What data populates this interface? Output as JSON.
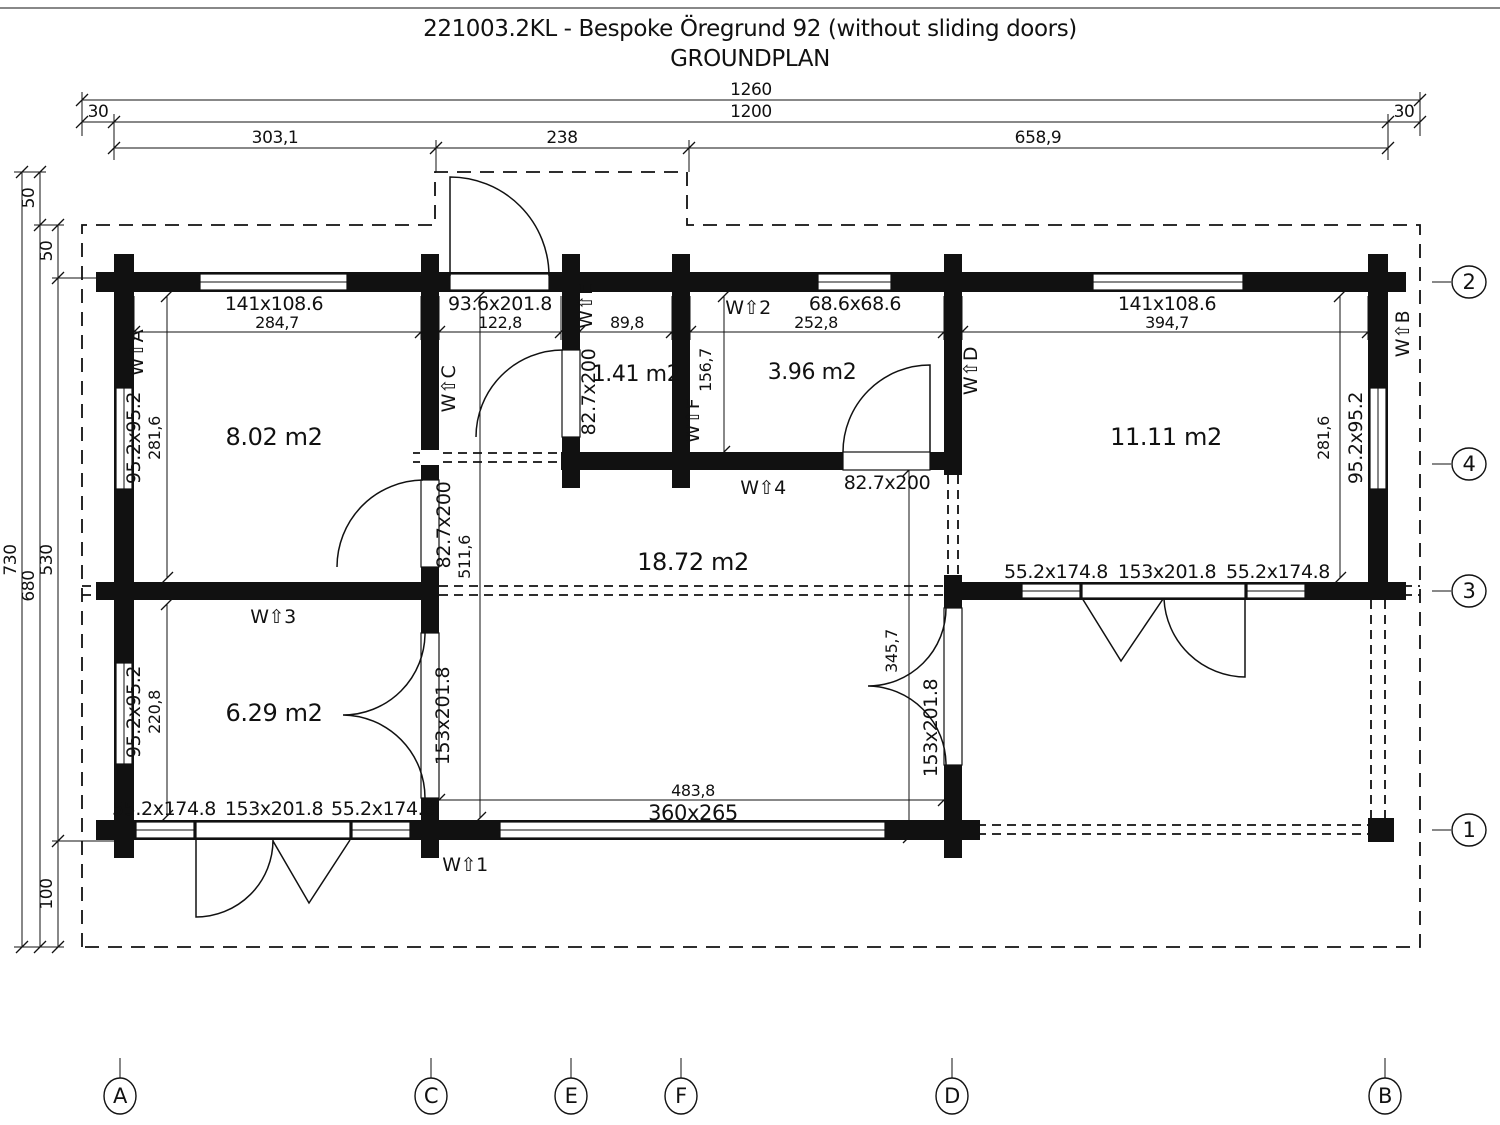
{
  "title": "221003.2KL - Bespoke Öregrund 92 (without sliding doors)",
  "subtitle": "GROUNDPLAN",
  "dims": {
    "top": {
      "overall": "1260",
      "margin_left": "30",
      "inner": "1200",
      "margin_right": "30",
      "seg_left": "303,1",
      "seg_mid": "238",
      "seg_right": "658,9"
    },
    "left": {
      "overall": "730",
      "body": "680",
      "canopy": "50",
      "eave": "50",
      "wall": "530",
      "deck": "100"
    },
    "inner": {
      "a_c": "284,7",
      "c_e": "122,8",
      "e_f": "89,8",
      "f_d": "252,8",
      "d_b": "394,7",
      "left_top": "281,6",
      "left_bottom": "220,8",
      "right": "281,6",
      "corridor": "511,6",
      "hall": "345,7",
      "wc": "156,7",
      "bottom": "483,8"
    }
  },
  "rooms": {
    "top_left": "8.02 m2",
    "small": "1.41 m2",
    "mid": "3.96 m2",
    "top_right": "11.11 m2",
    "main": "18.72 m2",
    "bottom_left": "6.29 m2"
  },
  "openings": {
    "win_top_left": "141x108.6",
    "main_door": "93.6x201.8",
    "win_top_small": "68.6x68.6",
    "win_top_right": "141x108.6",
    "win_left_top": "95.2x95.2",
    "win_left_bottom": "95.2x95.2",
    "win_right": "95.2x95.2",
    "door_c": "82.7x200",
    "door_e": "82.7x200",
    "door_hall": "82.7x200",
    "door_c_lower": "153x201.8",
    "door_d_lower": "153x201.8",
    "bottom_win_left": "55.2x174.8",
    "bottom_door": "153x201.8",
    "bottom_win_right": "55.2x174.8",
    "right_win_left": "55.2x174.8",
    "right_door": "153x201.8",
    "right_win_right": "55.2x174.8",
    "opening_360": "360x265"
  },
  "markers": {
    "wa": "W⇧A",
    "wb": "W⇧B",
    "wc": "W⇧C",
    "wd": "W⇧D",
    "we": "W⇧E",
    "wf": "W⇧F",
    "w1": "W⇧1",
    "w2": "W⇧2",
    "w3": "W⇧3",
    "w4": "W⇧4"
  },
  "grid": {
    "col_a": "A",
    "col_c": "C",
    "col_e": "E",
    "col_f": "F",
    "col_d": "D",
    "col_b": "B",
    "row_1": "1",
    "row_2": "2",
    "row_3": "3",
    "row_4": "4"
  }
}
